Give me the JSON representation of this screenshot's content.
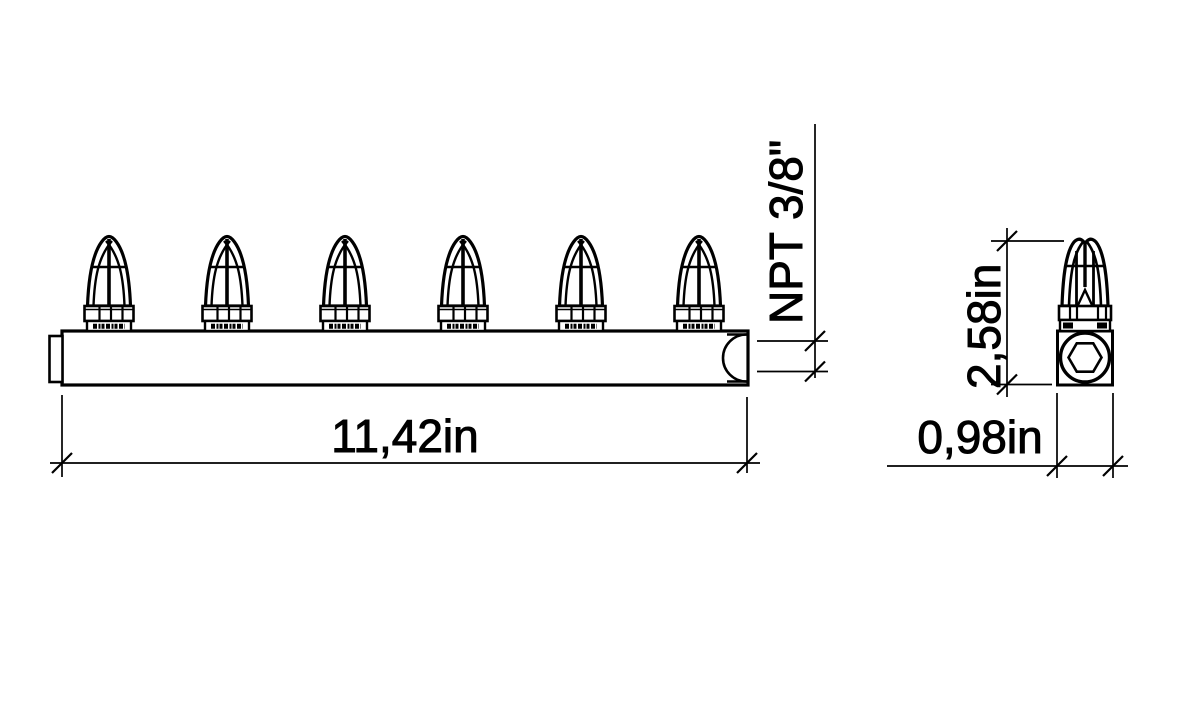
{
  "drawing": {
    "dimension_labels": {
      "overall_length": "11,42in",
      "port_thread": "NPT 3/8\"",
      "overall_height": "2,58in",
      "body_width": "0,98in"
    },
    "front_view": {
      "description": "manifold-bar-with-nozzles",
      "nozzle_count": 6
    },
    "side_view": {
      "description": "single-nozzle-on-square-block-with-hex-socket",
      "nozzle_count": 1
    },
    "colors": {
      "line": "#000000",
      "background": "#ffffff"
    }
  }
}
